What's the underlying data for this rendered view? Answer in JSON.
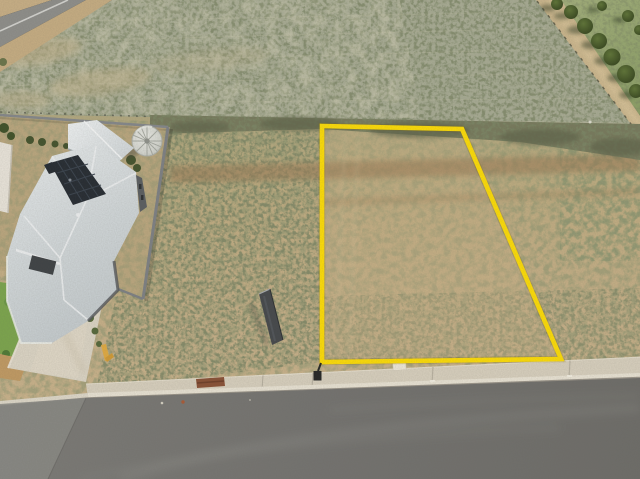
{
  "scene": {
    "type": "aerial-drone-photo",
    "subject": "Vacant residential land lot outlined in yellow, beside a new house with solar panels, farmland paddock behind and a suburban street in front",
    "objects": [
      "lot-boundary-outline",
      "farm-paddock",
      "rural-sealed-road",
      "tree-lined-farm-track",
      "house-with-solar-panels",
      "verandah-roof",
      "water-tank",
      "yard-fence",
      "neighbour-wall",
      "lawn",
      "garden-shrubs",
      "concrete-driveway",
      "for-sale-sign-back",
      "survey-peg",
      "doormat-on-footpath",
      "yellow-marker-stick",
      "concrete-footpath",
      "kerb",
      "street-asphalt"
    ],
    "palette": {
      "boundary": "#FFDE06",
      "dirt_base": "#C6B087",
      "lot_interior": "#C9B287",
      "brown_streak": "#9D7C55",
      "paddock": "#A8AC94",
      "scrub": "#787B5D",
      "grass": "#9CAB74",
      "track": "#CDB88E",
      "sealed_road": "#8F8F8B",
      "tree": "#41552A",
      "roof": "#D5DADC",
      "verandah": "#E3E7E8",
      "solar": "#252B32",
      "tank": "#DADCD5",
      "fence": "#85888B",
      "wall": "#EBE6DC",
      "lawn": "#7CA64D",
      "driveway": "#DDD6C6",
      "footpath": "#D9D1BF",
      "kerb": "#EAE4D5",
      "road": "#757471",
      "road_light": "#8B8B86",
      "sign": "#45484B",
      "mat": "#8A5136",
      "stick": "#E2AB41"
    }
  }
}
